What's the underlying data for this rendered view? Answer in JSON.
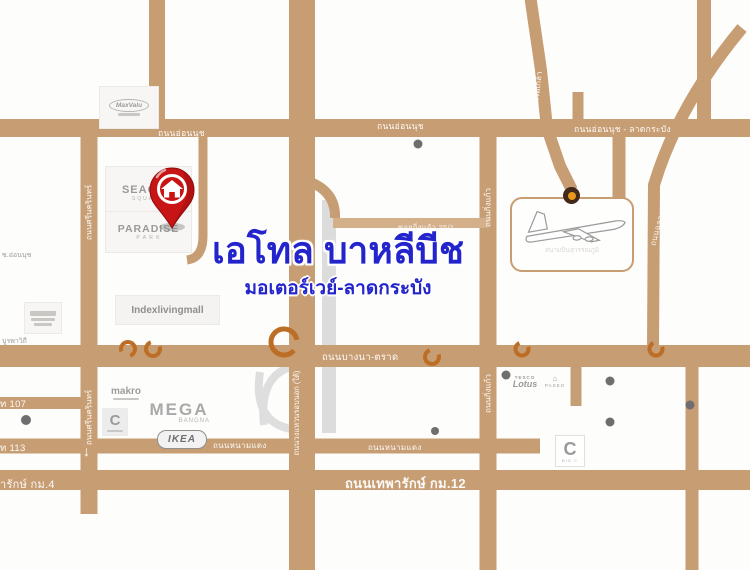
{
  "map": {
    "title": "เอโทล บาหลีบีช",
    "subtitle": "มอเตอร์เวย์-ลาดกระบัง",
    "colors": {
      "road_tan": "#C79D73",
      "road_minor": "#D3B08A",
      "interchange_orange": "#BC6E26",
      "title_blue": "#2424CC",
      "pin_red": "#C81414"
    },
    "roads": {
      "on_nut_left": "ถนนอ่อนนุช",
      "on_nut_mid": "ถนนอ่อนนุช",
      "on_nut_ladkrabang": "ถนนอ่อนนุช - ลาดกระบัง",
      "srinakarin_top": "ถนนศรีนครินทร์",
      "srinakarin_bottom": "ถนนศรีนครินทร์",
      "king_kaew_top": "ถนนกิ่งแก้ว",
      "king_kaew_bottom": "ถนนกิ่งแก้ว",
      "soi_king_kaew_25_1": "ซอยกิ่งแก้ว 25/1",
      "bangna_trat": "ถนนบางนา-ตราด",
      "outer_ring": "ถนนวงแหวนรอบนอก (ใต้)",
      "nam_daeng_left": "ถนนหนามแดง",
      "nam_daeng_mid": "ถนนหนามแดง",
      "thepharak_km12": "ถนนเทพารักษ์ กม.12",
      "thepharak_km4": "ารักษ์ กม.4",
      "sukhumvit_107": "ท 107",
      "sukhumvit_113": "ท 113",
      "burapha_withi": "บูรพาวิถี",
      "soi_on_nut": "ซ.อ่อนนุช",
      "rom_klao": "ถนนร่มเกล้า",
      "chalong_krung": "ถนนฉลองกรุง",
      "arrow_down": "↓"
    },
    "landmarks": {
      "maxvalu": "MaxValu",
      "seacon_line1": "SEACON",
      "seacon_line2": "SQUARE",
      "paradise_line1": "PARADISE",
      "paradise_line2": "P A R K",
      "index_living_mall": "Indexlivingmall",
      "makro": "makro",
      "big_c_west": "C",
      "mega_line1": "MEGA",
      "mega_line2": "BANGNA",
      "ikea": "IKEA",
      "tesco_line1": "TESCO",
      "tesco_line2": "Lotus",
      "paseo": "PASEO",
      "big_c_east": "C",
      "big_c_east_caption": "BIG C",
      "airport": "สนามบินสุวรรณภูมิ"
    }
  }
}
